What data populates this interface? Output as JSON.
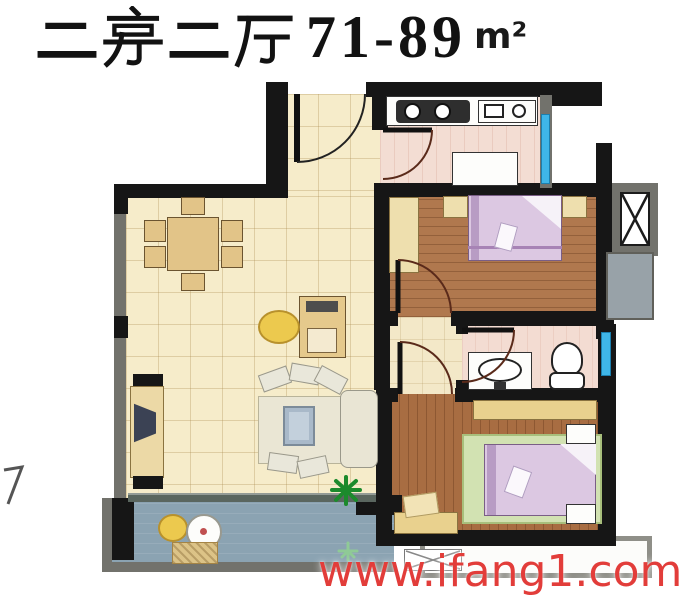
{
  "title": {
    "cjk_text": "二房二厅",
    "area_range": "71-89",
    "area_unit": "m²",
    "full": "二房二厅71-89m²"
  },
  "watermark": {
    "text": "www.ifang1.com",
    "color": "#e23d3a"
  },
  "colors": {
    "wall": "#161616",
    "window_wall_gray": "#72726c",
    "window_glass_blue": "#3fb6e8",
    "floor_tile_cream": "#f6ecca",
    "floor_kitchen_pink": "#f3ddd3",
    "floor_bathroom_pink": "#f3dcd2",
    "floor_bedroom_wood": "#b0784e",
    "floor_corridor_beige": "#f3e8c8",
    "floor_balcony_blue": "#8ba3b2",
    "bed_linen_lavender": "#dcc8e2",
    "rug_green": "#d2e2b2",
    "furniture_wood_tan": "#e2c488",
    "watermark_red": "#e23d3a",
    "title_black": "#121212"
  },
  "floorplan": {
    "layout_label": "2-bedroom 2-hall apartment floor plan",
    "rooms": [
      {
        "id": "living-dining",
        "floor": "cream-tile",
        "furniture": [
          "dining-table-with-6-chairs",
          "desk-with-round-chair",
          "sofa-set-with-coffee-table",
          "tv-cabinet",
          "potted-plant"
        ]
      },
      {
        "id": "entry-hall",
        "floor": "cream-tile",
        "furniture": [
          "entry-door"
        ]
      },
      {
        "id": "kitchen",
        "floor": "pink-tile",
        "furniture": [
          "stove-two-burners",
          "counter-sink",
          "fridge"
        ]
      },
      {
        "id": "bedroom-top",
        "floor": "wood-plank",
        "furniture": [
          "double-bed",
          "nightstand-left",
          "nightstand-right",
          "wardrobe"
        ]
      },
      {
        "id": "bathroom",
        "floor": "pink-tile",
        "furniture": [
          "washbasin",
          "toilet"
        ]
      },
      {
        "id": "bedroom-bottom",
        "floor": "wood-plank",
        "furniture": [
          "double-bed-on-green-rug",
          "nightstand-top",
          "nightstand-bottom",
          "wardrobe",
          "bench-with-cushion"
        ]
      },
      {
        "id": "balcony",
        "floor": "blue-gray",
        "furniture": [
          "round-table",
          "round-chair",
          "mat",
          "plant"
        ]
      },
      {
        "id": "elevator-shaft",
        "floor": "gray",
        "furniture": [
          "elevator-x-symbol"
        ]
      },
      {
        "id": "bay-window-bottom-right",
        "floor": "white-sill",
        "furniture": [
          "crossed-window-symbol"
        ]
      }
    ]
  }
}
